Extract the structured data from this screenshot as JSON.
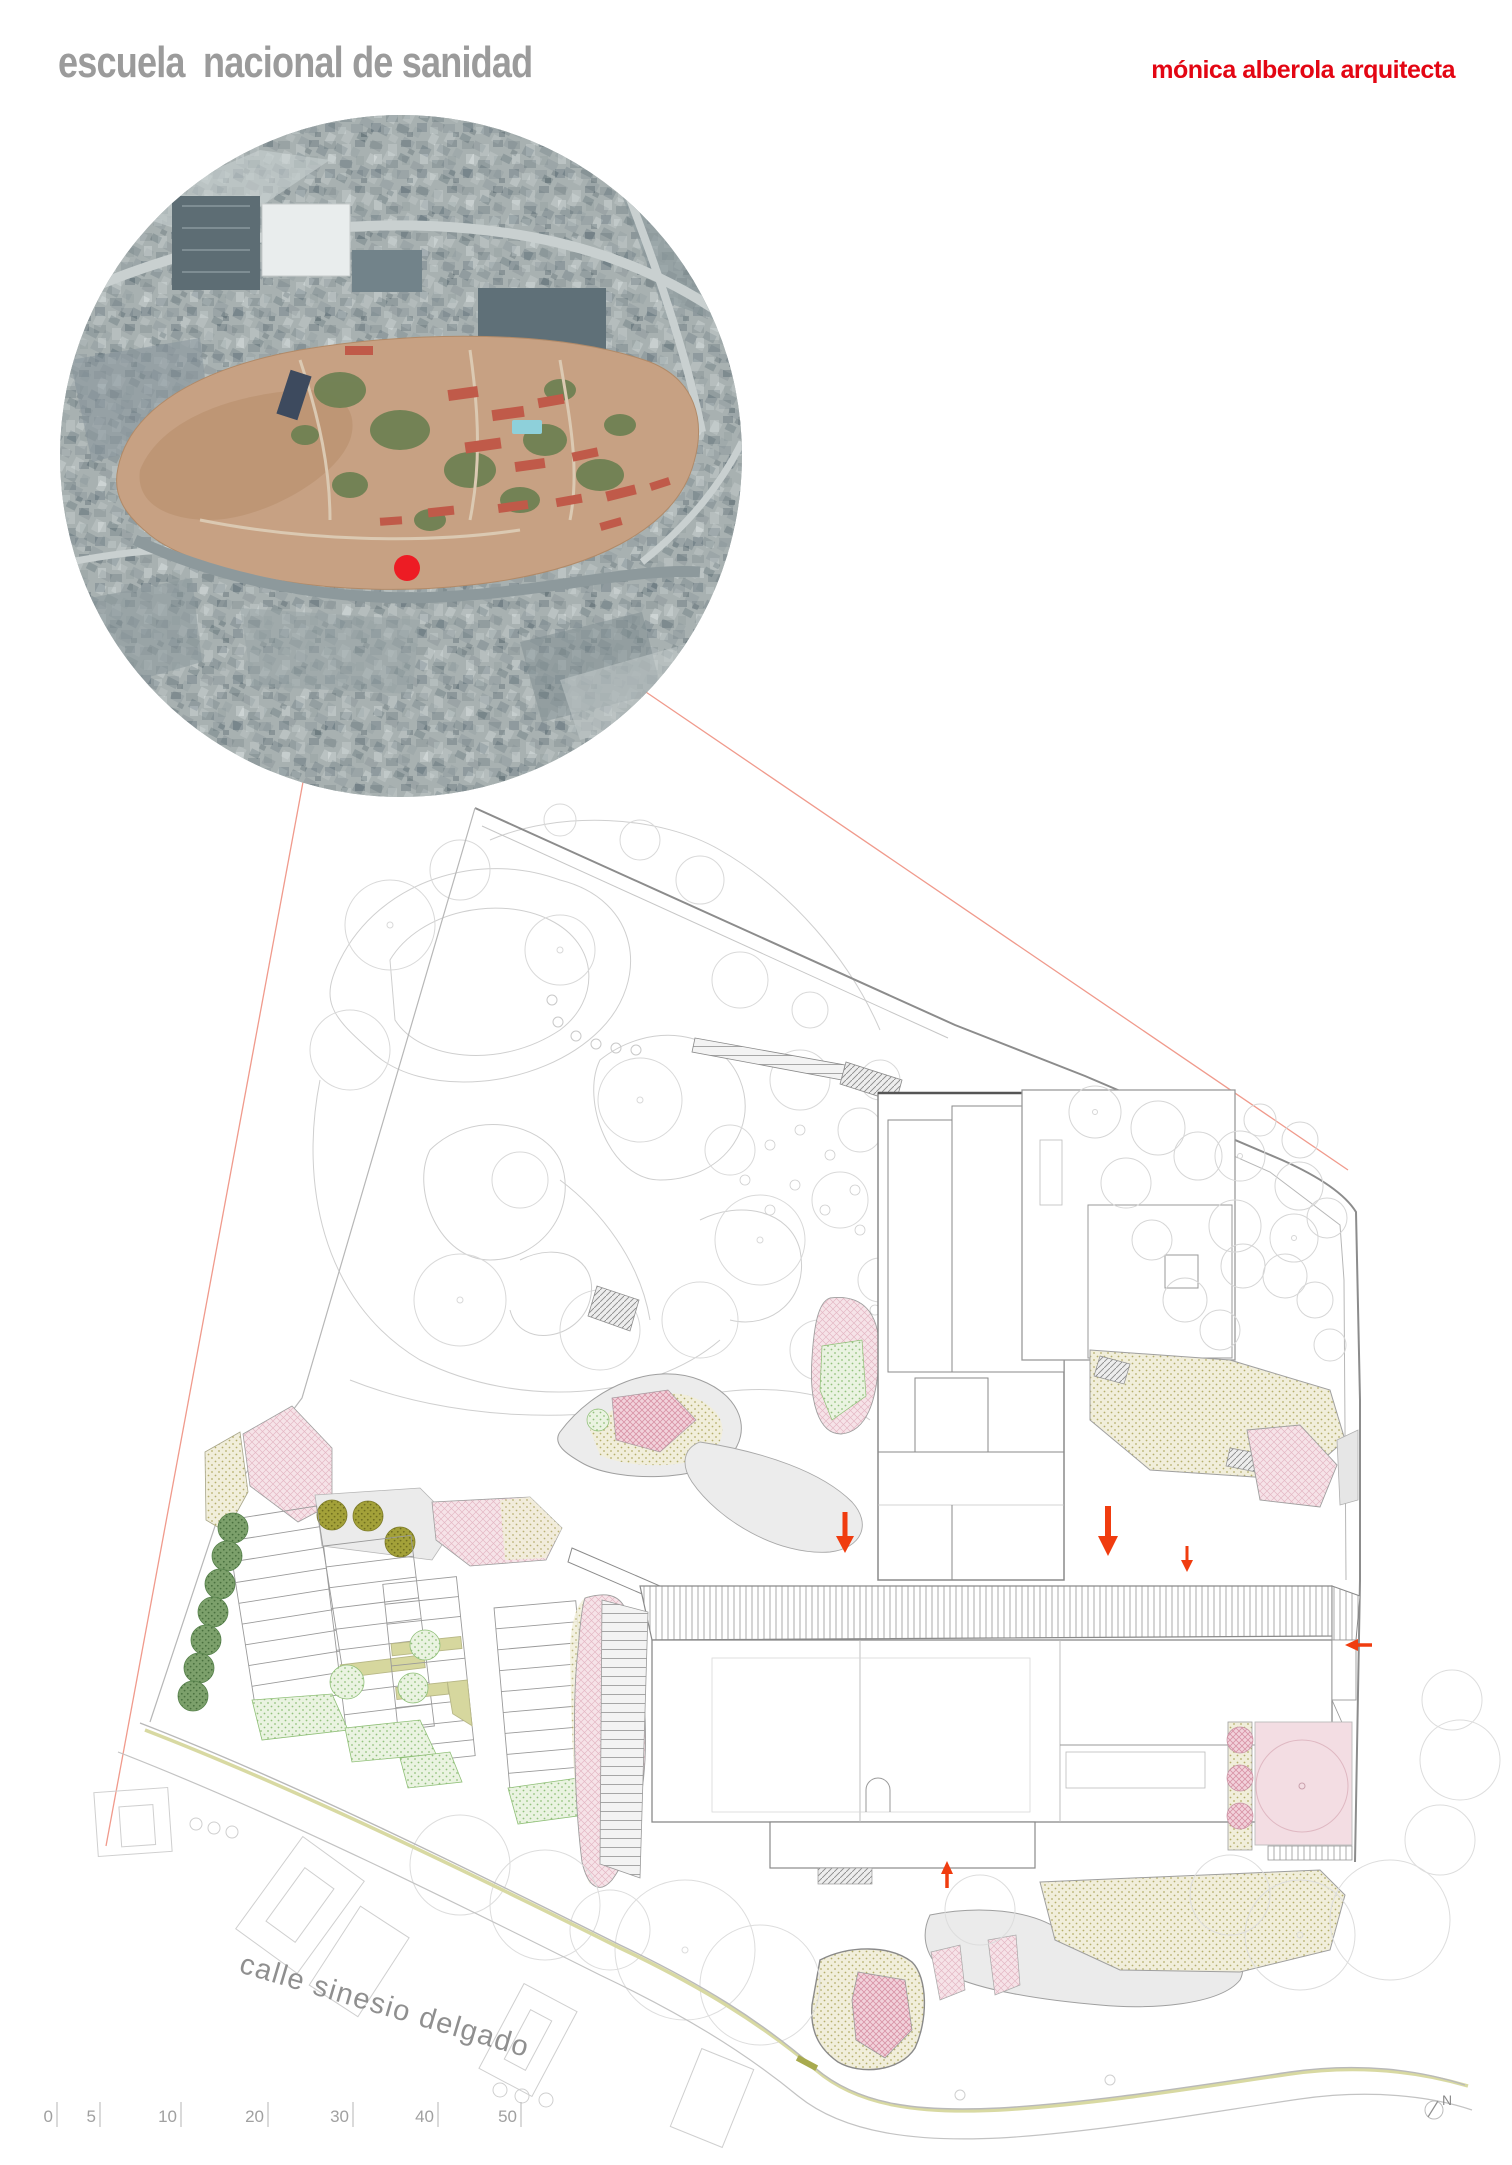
{
  "header": {
    "title": "escuela  nacional de sanidad",
    "architect": "mónica alberola arquitecta"
  },
  "plan": {
    "street_label": "calle sinesio delgado",
    "north_label": "N"
  },
  "scale_bar": {
    "labels": [
      "0",
      "5",
      "10",
      "20",
      "30",
      "40",
      "50"
    ]
  },
  "colors": {
    "accent_red": "#e30613",
    "arrow_orange": "#f03c0f",
    "marker_red": "#ed1c24",
    "leader_line": "#f09a8c",
    "title_gray": "#9b9b9b",
    "line_gray": "#9a9a9a",
    "pink_fill": "#f6e3e8",
    "khaki": "#d6d79e",
    "tree_green": "#7ca06b",
    "olive_green": "#a3a139"
  },
  "icons": {
    "north": "north-indicator",
    "site_marker": "site-location-dot"
  }
}
